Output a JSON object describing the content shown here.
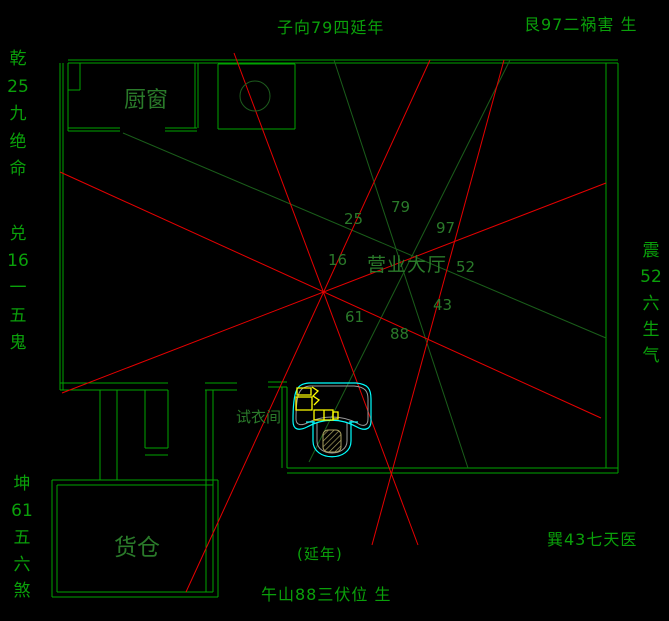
{
  "canvas": {
    "width": 669,
    "height": 621,
    "background": "#000000"
  },
  "colors": {
    "background": "#000000",
    "wall_green": "#00a300",
    "wall_dark_green": "#1d5c1d",
    "diagonal_green": "#1a5e1a",
    "red_line": "#e60000",
    "cyan": "#00ffff",
    "yellow": "#ffff00",
    "gray": "#9a9a9a",
    "hatch": "#a89f60",
    "label_outer_green": "#0aa00a",
    "label_inner_green": "#2a7a2a"
  },
  "compass": {
    "top_center": "子向79四延年",
    "top_right": "艮97二祸害 生",
    "left_top": "乾\n25\n九\n绝\n命",
    "left_middle": "兑\n16\n一\n五\n鬼",
    "left_bottom": "坤\n61\n五\n六\n煞",
    "right_middle": "震\n52\n六\n生\n气",
    "bottom_right": "巽43七天医",
    "bottom_note": "(延年)",
    "bottom_center": "午山88三伏位 生"
  },
  "rooms": {
    "kitchen": "厨窗",
    "hall": "营业大厅",
    "fitting": "试衣间",
    "warehouse": "货仓"
  },
  "sector_numbers": {
    "n25": "25",
    "n79": "79",
    "n97": "97",
    "n16": "16",
    "n52": "52",
    "n61": "61",
    "n88": "88",
    "n43": "43"
  }
}
